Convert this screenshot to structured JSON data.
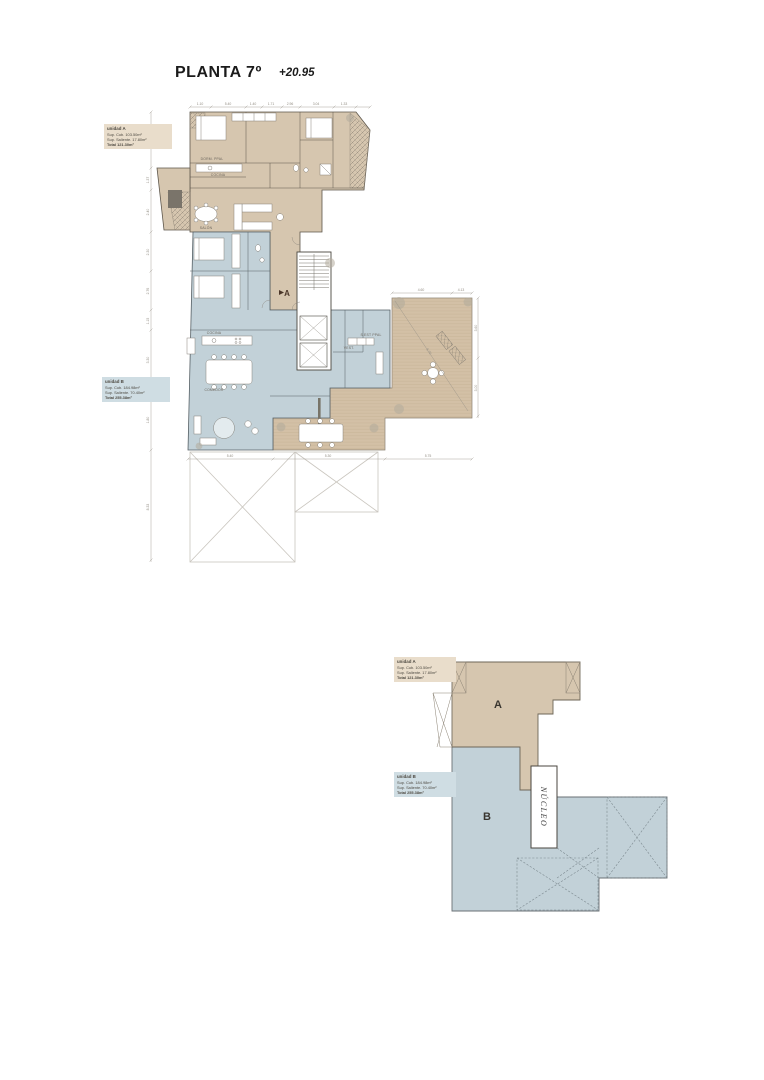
{
  "title": {
    "name": "PLANTA 7º",
    "elevation": "+20.95"
  },
  "units": {
    "a": {
      "name": "unidad A",
      "sup_cub": "Sup. Cub. 103.50m²",
      "sup_saliente": "Sup. Saliente. 17.80m²",
      "total": "Total 121.30m²",
      "letter": "A"
    },
    "b": {
      "name": "unidad B",
      "sup_cub": "Sup. Cub. 184.98m²",
      "sup_saliente": "Sup. Saliente. 70.40m²",
      "total": "Total 255.38m²",
      "letter": "B"
    }
  },
  "plan": {
    "marker_a": "A",
    "rooms": {
      "dorm_ppal": "DORM. PPAL",
      "cocina": "COCINA",
      "salon": "SALÓN",
      "comedor": "COMEDOR",
      "s_est_ppal": "S.EST PPAL",
      "vest": "VEST."
    },
    "dims": {
      "top": [
        "1.10",
        "5.40",
        "1.40",
        "1.71",
        "2.96",
        "3.04",
        "1.33"
      ],
      "left": [
        "3.18",
        "1.37",
        "2.40",
        "2.30",
        "2.76",
        "1.15",
        "3.30",
        "1.80",
        "8.33"
      ],
      "bottom": [
        "5.40",
        "5.30",
        "5.75"
      ],
      "right": [
        "3.60",
        "3.00"
      ],
      "terrace_top": [
        "4.60",
        "4.13"
      ],
      "diagonal": "6.70"
    }
  },
  "key_plan": {
    "nucleo": "NÚCLEO"
  },
  "colors": {
    "unit_a": "#d6c6af",
    "unit_b": "#c2d1d8",
    "terrace": "#d3c0a6",
    "label_a_bg": "#e9ddcb",
    "label_b_bg": "#cfdde3",
    "wall": "#5d564b",
    "wall_b": "#566065",
    "dim": "#948f85",
    "ink": "#1b1b1b",
    "marker": "#4a3528"
  }
}
